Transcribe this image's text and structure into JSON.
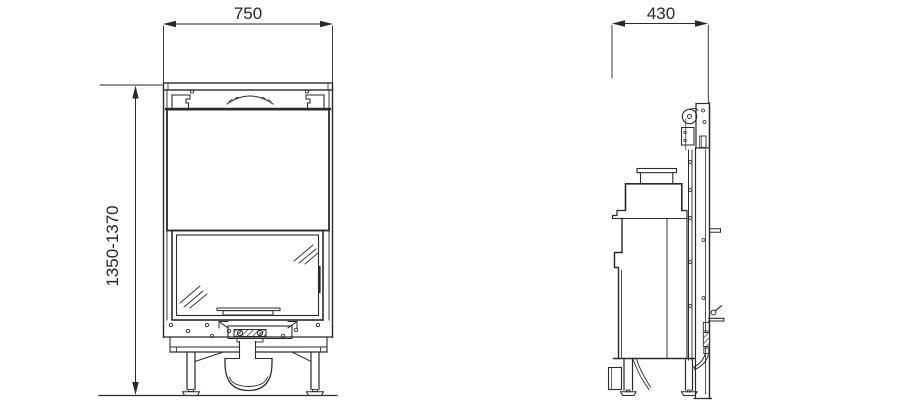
{
  "drawing": {
    "front_view": {
      "width_label": "750",
      "height_label": "1350-1370"
    },
    "side_view": {
      "depth_label": "430"
    },
    "colors": {
      "line": "#2a2a2a",
      "text": "#262626",
      "background": "#ffffff"
    }
  }
}
